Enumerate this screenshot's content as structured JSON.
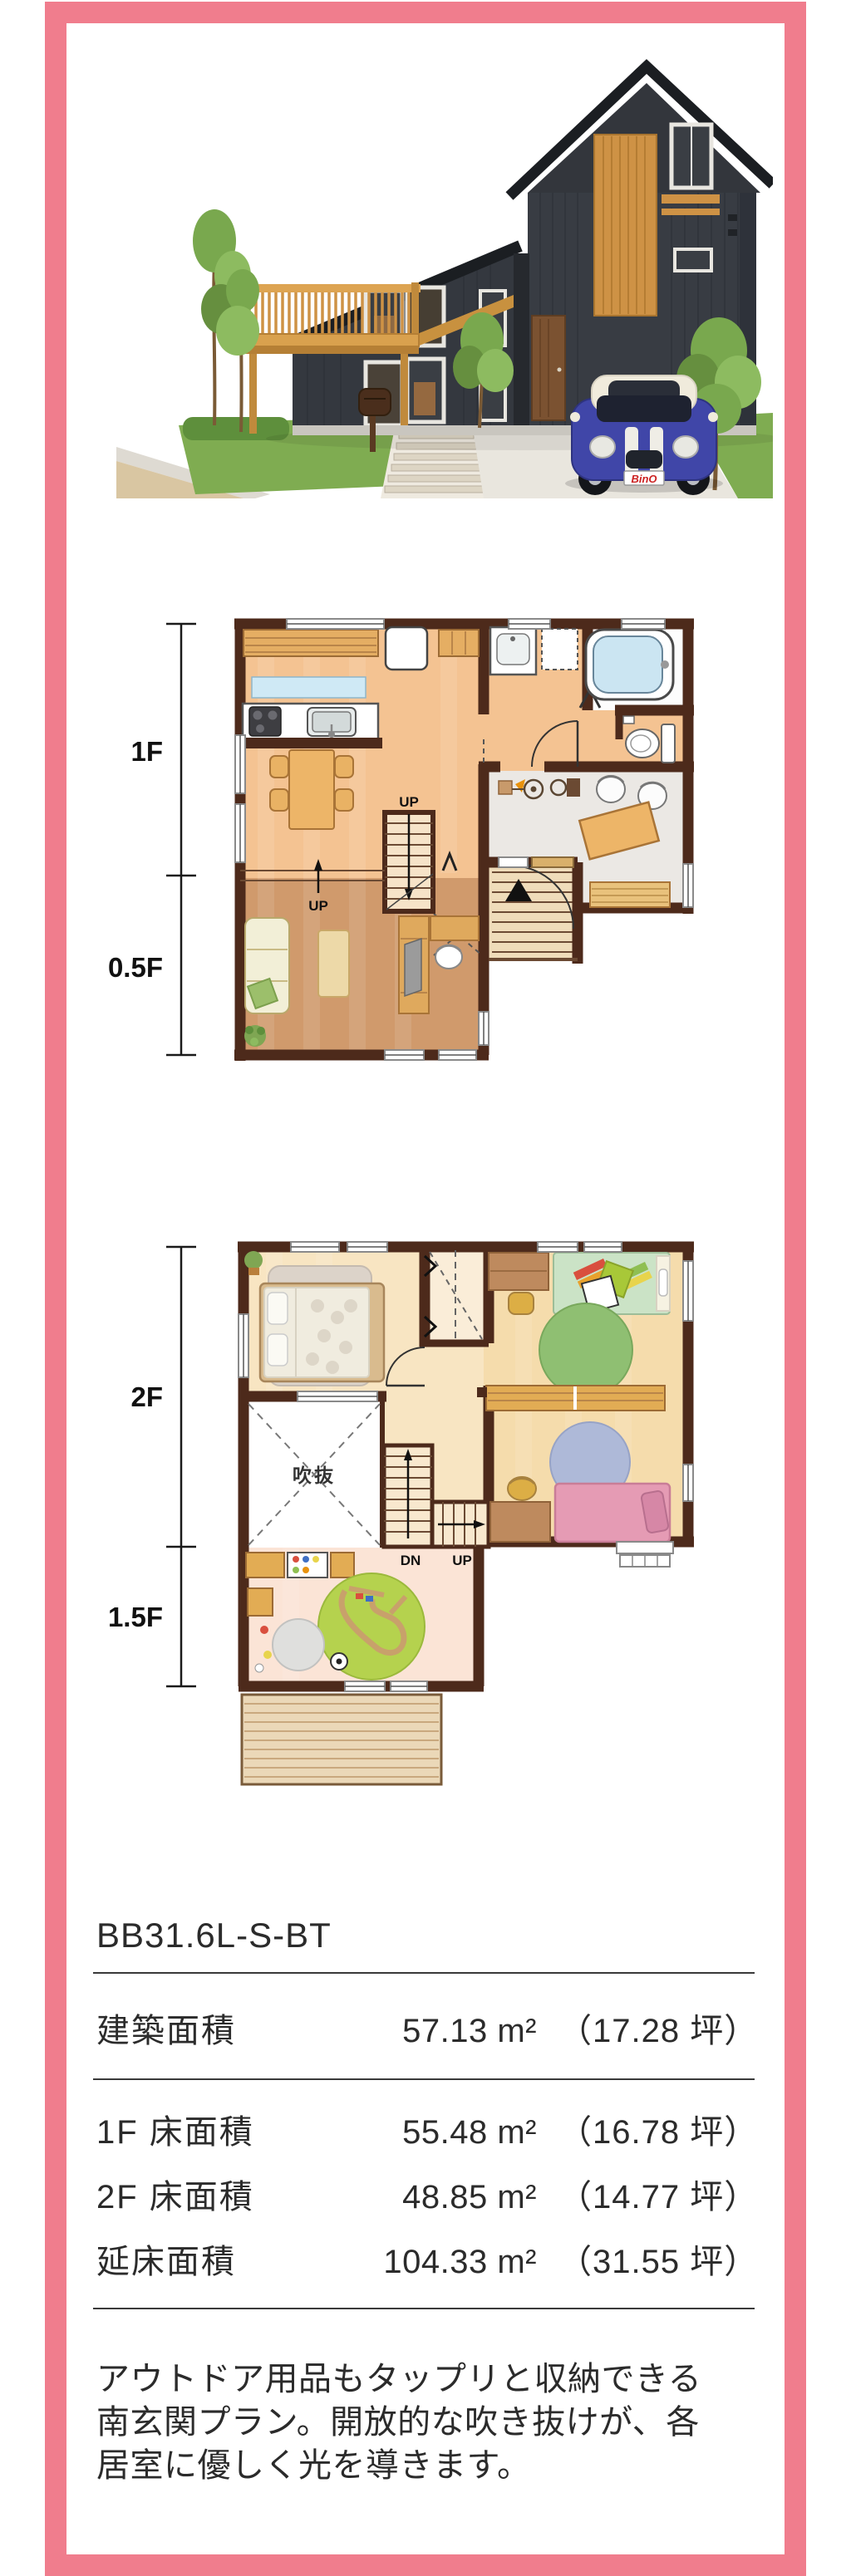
{
  "page": {
    "frame_color": "#F07D8D",
    "background": "#FFFFFF"
  },
  "hero": {
    "car_plate": "BinO"
  },
  "plan_first": {
    "dim_upper": "1F",
    "dim_lower": "0.5F",
    "stairs_up": "UP",
    "step_up": "UP"
  },
  "plan_second": {
    "dim_upper": "2F",
    "dim_lower": "1.5F",
    "void": "吹抜",
    "down": "DN",
    "up": "UP"
  },
  "spec": {
    "model_code": "BB31.6L-S-BT",
    "building_area": {
      "label": "建築面積",
      "value": "57.13 m²",
      "tsubo": "（17.28 坪）"
    },
    "floor_areas": [
      {
        "label": "1F 床面積",
        "value": "55.48 m²",
        "tsubo": "（16.78 坪）"
      },
      {
        "label": "2F 床面積",
        "value": "48.85 m²",
        "tsubo": "（14.77 坪）"
      },
      {
        "label": "延床面積",
        "value": "104.33 m²",
        "tsubo": "（31.55 坪）"
      }
    ],
    "description": "アウトドア用品もタップリと収納できる南玄関プラン。開放的な吹き抜けが、各居室に優しく光を導きます。"
  }
}
